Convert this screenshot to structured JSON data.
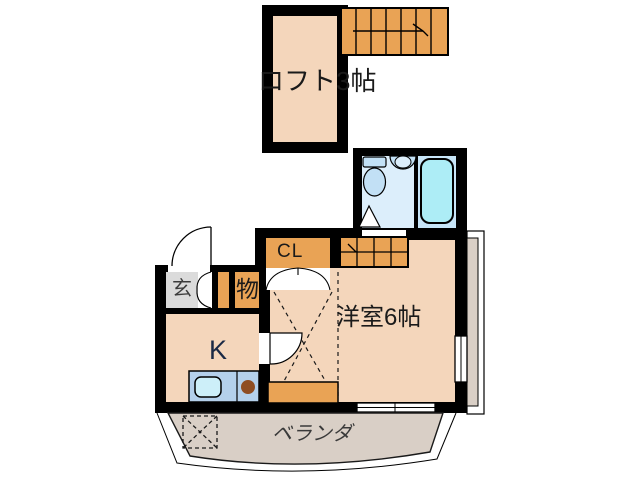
{
  "floor_plan": {
    "type": "apartment-madori",
    "labels": {
      "loft": "ロフト3帖",
      "closet": "CL",
      "storage": "物",
      "entrance": "玄",
      "kitchen": "K",
      "room": "洋室6帖",
      "veranda": "ベランダ"
    },
    "rooms": [
      {
        "name": "ロフト3帖",
        "kind": "loft"
      },
      {
        "name": "洋室6帖",
        "kind": "western-room"
      },
      {
        "name": "K",
        "kind": "kitchen"
      },
      {
        "name": "玄",
        "kind": "entrance"
      },
      {
        "name": "物",
        "kind": "storage"
      },
      {
        "name": "CL",
        "kind": "closet"
      },
      {
        "name": "ベランダ",
        "kind": "veranda"
      }
    ],
    "colors": {
      "wall": "#000000",
      "room_fill": "#F4D6BB",
      "stair_orange": "#E9A355",
      "bath_left": "#DCEEFB",
      "bath_right": "#C7E5F8",
      "tub": "#ADEDF6",
      "fixture": "#C2E0F5",
      "counter": "#B4D0EB",
      "sink": "#CDEFF9",
      "burner": "#8F4D22",
      "entrance_gray": "#DBDBDB",
      "veranda_fill": "#D9CFC6",
      "text": "#1A1A1A"
    }
  }
}
